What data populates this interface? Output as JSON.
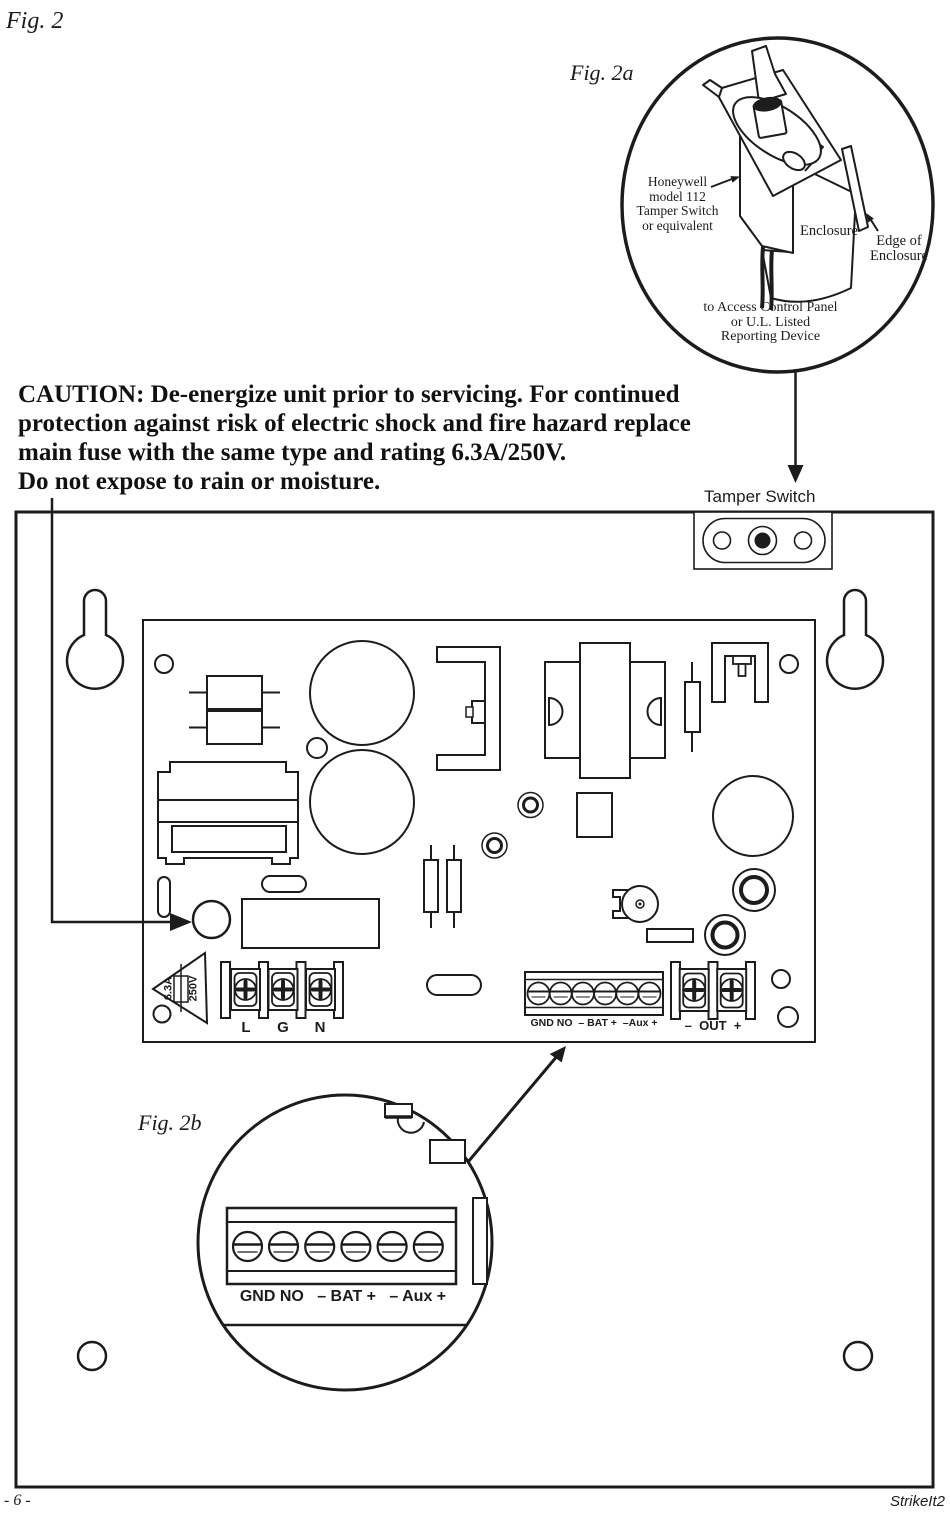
{
  "figure": {
    "fig2": "Fig. 2",
    "fig2a": "Fig. 2a",
    "fig2b": "Fig. 2b"
  },
  "caution": {
    "line1": "CAUTION: De-energize unit prior to servicing. For continued",
    "line2": "protection against risk of electric shock and fire hazard replace",
    "line3": "main fuse with the same type and rating 6.3A/250V.",
    "line4": "Do not expose to rain or moisture."
  },
  "fig2a": {
    "switch_note_l1": "Honeywell",
    "switch_note_l2": "model 112",
    "switch_note_l3": "Tamper Switch",
    "switch_note_l4": "or equivalent",
    "enclosure": "Enclosure",
    "edge_l1": "Edge of",
    "edge_l2": "Enclosure",
    "wire_l1": "to Access Control Panel",
    "wire_l2": "or U.L. Listed",
    "wire_l3": "Reporting Device"
  },
  "panel": {
    "tamper_switch": "Tamper Switch",
    "fuse_amps": "6.3A",
    "fuse_volts": "250V",
    "terminal_l": "L",
    "terminal_g": "G",
    "terminal_n": "N",
    "dc_strip": "GND NO  – BAT +  –Aux +",
    "out_strip": "–  OUT  +"
  },
  "fig2b": {
    "dc_strip": "GND NO   – BAT +   – Aux +"
  },
  "footer": {
    "page_number": "- 6 -",
    "doc_code": "StrikeIt2"
  }
}
